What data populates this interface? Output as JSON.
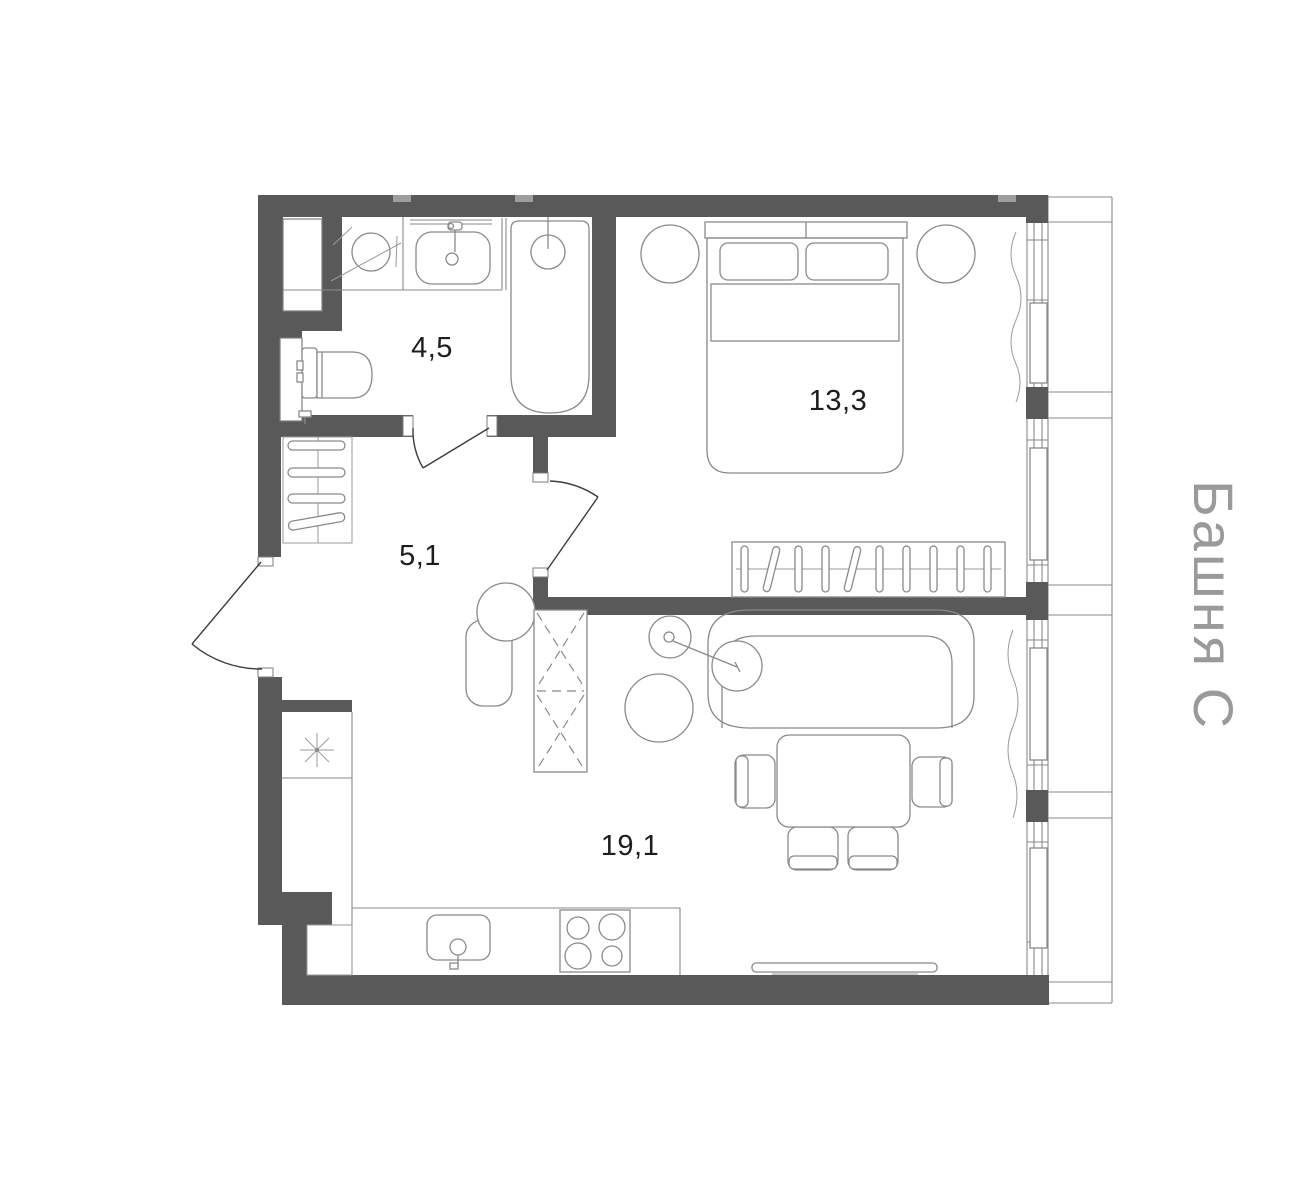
{
  "tower_label": "Башня С",
  "rooms": [
    {
      "id": "bathroom",
      "area": "4,5"
    },
    {
      "id": "hallway",
      "area": "5,1"
    },
    {
      "id": "bedroom",
      "area": "13,3"
    },
    {
      "id": "living-kitchen",
      "area": "19,1"
    }
  ],
  "colors": {
    "wall": "#595959",
    "line": "#8a8a8a",
    "door_line": "#3c3c3c",
    "label_text": "#1d1d1d",
    "tower_text": "#9a9a9a",
    "background": "#ffffff"
  }
}
